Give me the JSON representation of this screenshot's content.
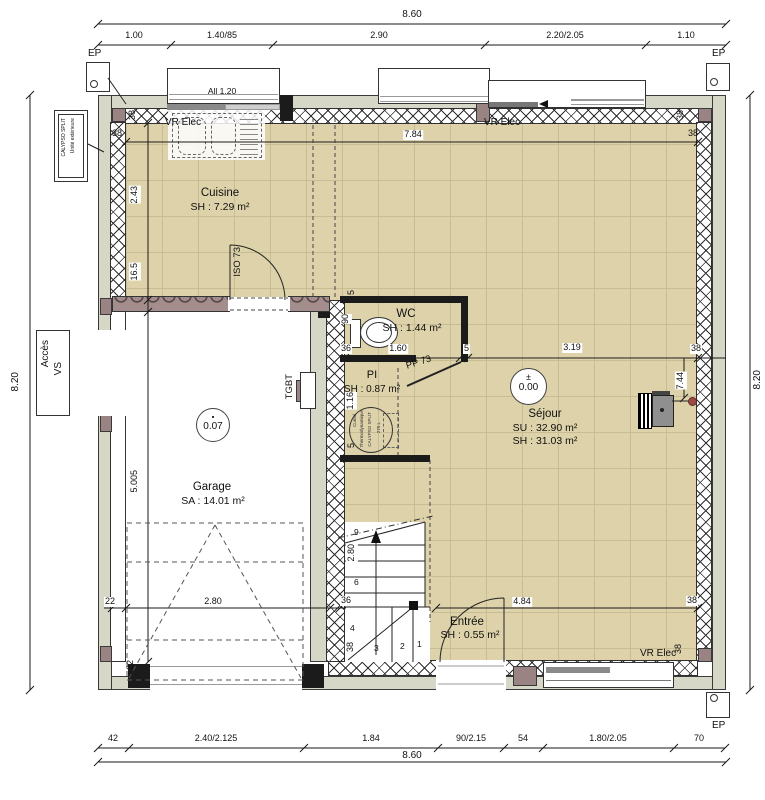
{
  "plan": {
    "rooms": {
      "cuisine": {
        "name": "Cuisine",
        "area": "SH : 7.29 m²"
      },
      "wc": {
        "name": "WC",
        "area": "SH : 1.44 m²"
      },
      "pi": {
        "name": "PI",
        "area": "SH : 0.87 m²"
      },
      "sejour": {
        "name": "Séjour",
        "su": "SU : 32.90 m²",
        "sh": "SH : 31.03 m²"
      },
      "garage": {
        "name": "Garage",
        "area": "SA : 14.01 m²"
      },
      "entree": {
        "name": "Entrée",
        "area": "SH : 0.55 m²"
      }
    },
    "levels": {
      "pm": "±",
      "sejour": "0.00",
      "garage": "0.07"
    },
    "doors": {
      "cuisine": "ISO 73",
      "wc": "PP 73"
    },
    "labels": {
      "ep": "EP",
      "vr_elec": "VR Elec",
      "allege": "All 1.20",
      "tgbt": "TGBT",
      "acces1": "Accès",
      "acces2": "VS",
      "calypso1": "CALYPSO SPLIT",
      "calypso2": "Unité extérieure",
      "cumul1": "Cumul",
      "cumul2": "Thermodynamique",
      "cumul3": "CALYPSO SPLIT",
      "cumul4": "270 L"
    },
    "stairs": {
      "n1": "1",
      "n2": "2",
      "n3": "3",
      "n4": "4",
      "n6": "6",
      "n9": "9"
    },
    "dims": {
      "top_overall": "8.60",
      "top": [
        "1.00",
        "1.40/85",
        "2.90",
        "2.20/2.05",
        "1.10"
      ],
      "bottom": [
        "42",
        "2.40/2.125",
        "1.84",
        "90/2.15",
        "54",
        "1.80/2.05",
        "70"
      ],
      "bottom_overall": "8.60",
      "left": "8.20",
      "right": "8.20",
      "interior_w": "7.84",
      "cuisine_h": "2.43",
      "wall_165": "16.5",
      "garage_h": "5.005",
      "garage_w": "2.80",
      "stair_h": "2.80",
      "wc_w": "1.60",
      "wc_d": "90",
      "sejour_w": "3.19",
      "pi_h": "1.16",
      "entree_w": "4.84",
      "stove": "7.44",
      "d38": "38",
      "d36": "36",
      "d5": "5",
      "d22": "22"
    }
  }
}
